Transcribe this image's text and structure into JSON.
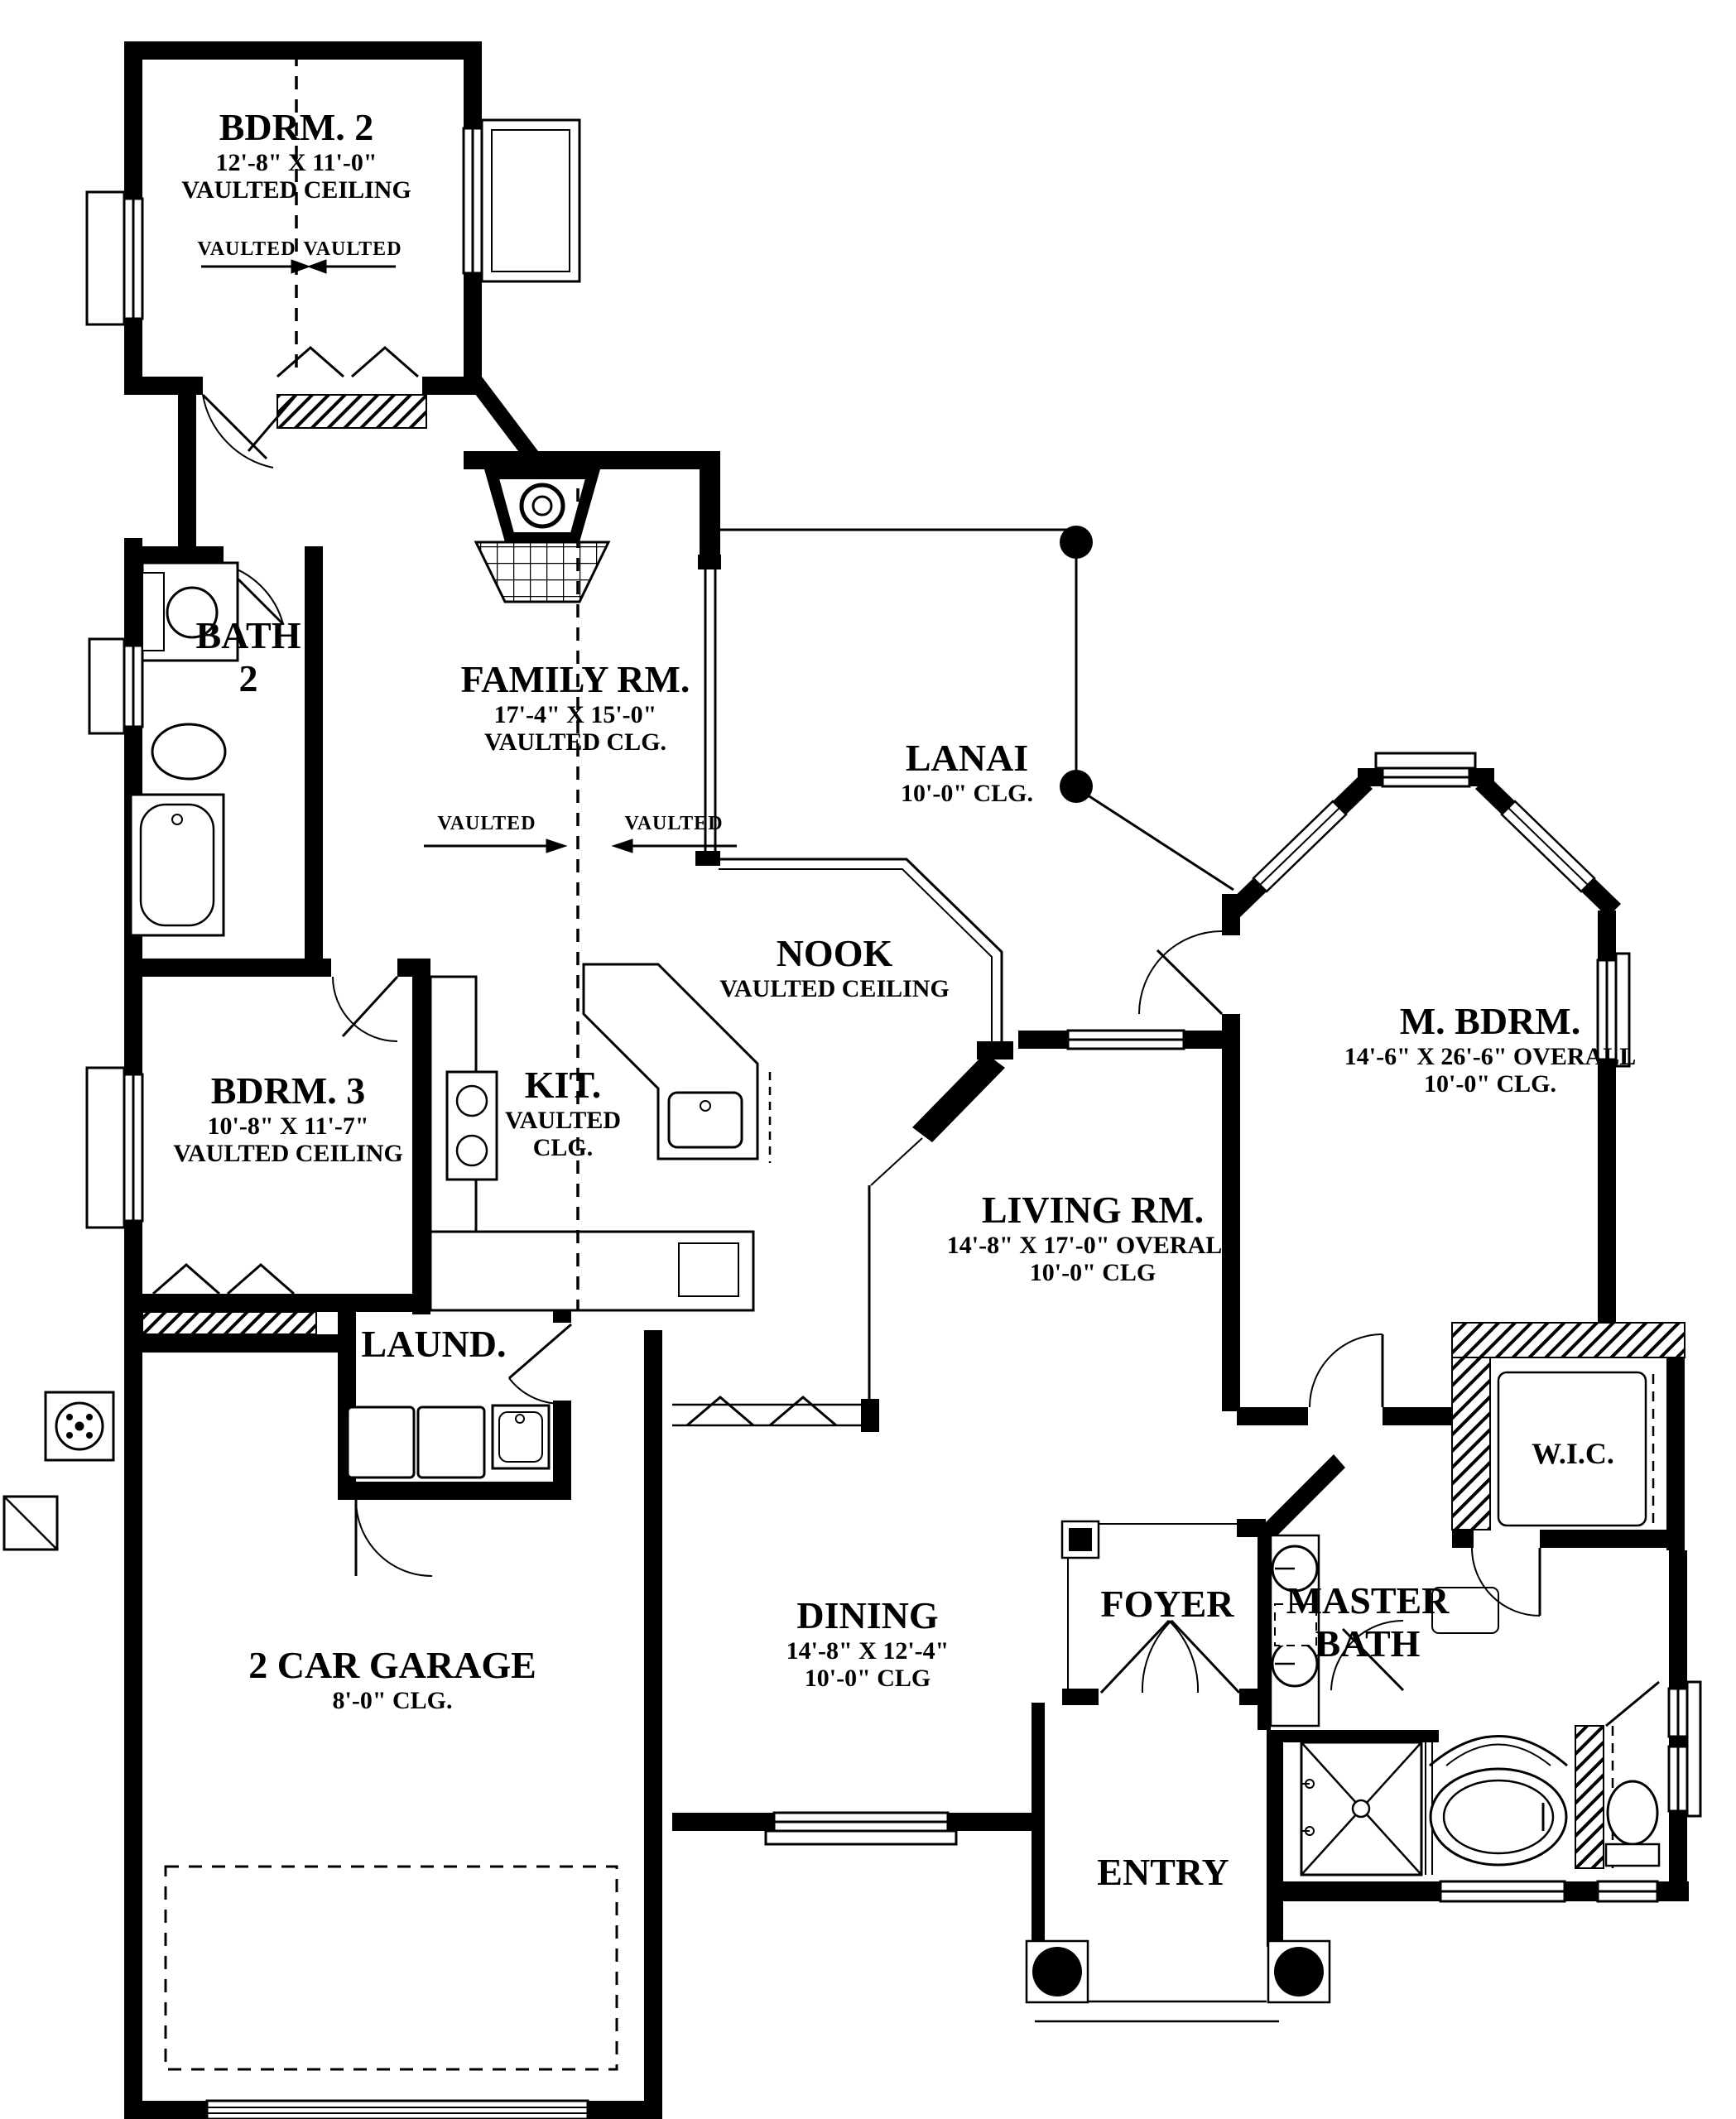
{
  "annotations": {
    "vaulted_label": "VAULTED"
  },
  "colors": {
    "ink": "#000000",
    "paper": "#ffffff"
  },
  "rooms": {
    "bdrm2": {
      "name": "BDRM. 2",
      "dims": "12'-8\" X 11'-0\"",
      "ceiling": "VAULTED CEILING"
    },
    "bath2": {
      "name_line1": "BATH",
      "name_line2": "2"
    },
    "family": {
      "name": "FAMILY RM.",
      "dims": "17'-4\" X 15'-0\"",
      "ceiling": "VAULTED CLG."
    },
    "lanai": {
      "name": "LANAI",
      "ceiling": "10'-0\" CLG."
    },
    "nook": {
      "name": "NOOK",
      "ceiling": "VAULTED CEILING"
    },
    "bdrm3": {
      "name": "BDRM. 3",
      "dims": "10'-8\" X 11'-7\"",
      "ceiling": "VAULTED CEILING"
    },
    "kitchen": {
      "name": "KIT.",
      "ceiling_line1": "VAULTED",
      "ceiling_line2": "CLG."
    },
    "master_bedroom": {
      "name": "M. BDRM.",
      "dims": "14'-6\" X 26'-6\" OVERALL",
      "ceiling": "10'-0\" CLG."
    },
    "living": {
      "name": "LIVING RM.",
      "dims": "14'-8\" X 17'-0\" OVERALL",
      "ceiling": "10'-0\" CLG"
    },
    "laundry": {
      "name": "LAUND."
    },
    "wic": {
      "name": "W.I.C."
    },
    "garage": {
      "name": "2 CAR GARAGE",
      "ceiling": "8'-0\" CLG."
    },
    "dining": {
      "name": "DINING",
      "dims": "14'-8\" X 12'-4\"",
      "ceiling": "10'-0\" CLG"
    },
    "foyer": {
      "name": "FOYER"
    },
    "master_bath": {
      "name_line1": "MASTER",
      "name_line2": "BATH"
    },
    "entry": {
      "name": "ENTRY"
    }
  }
}
